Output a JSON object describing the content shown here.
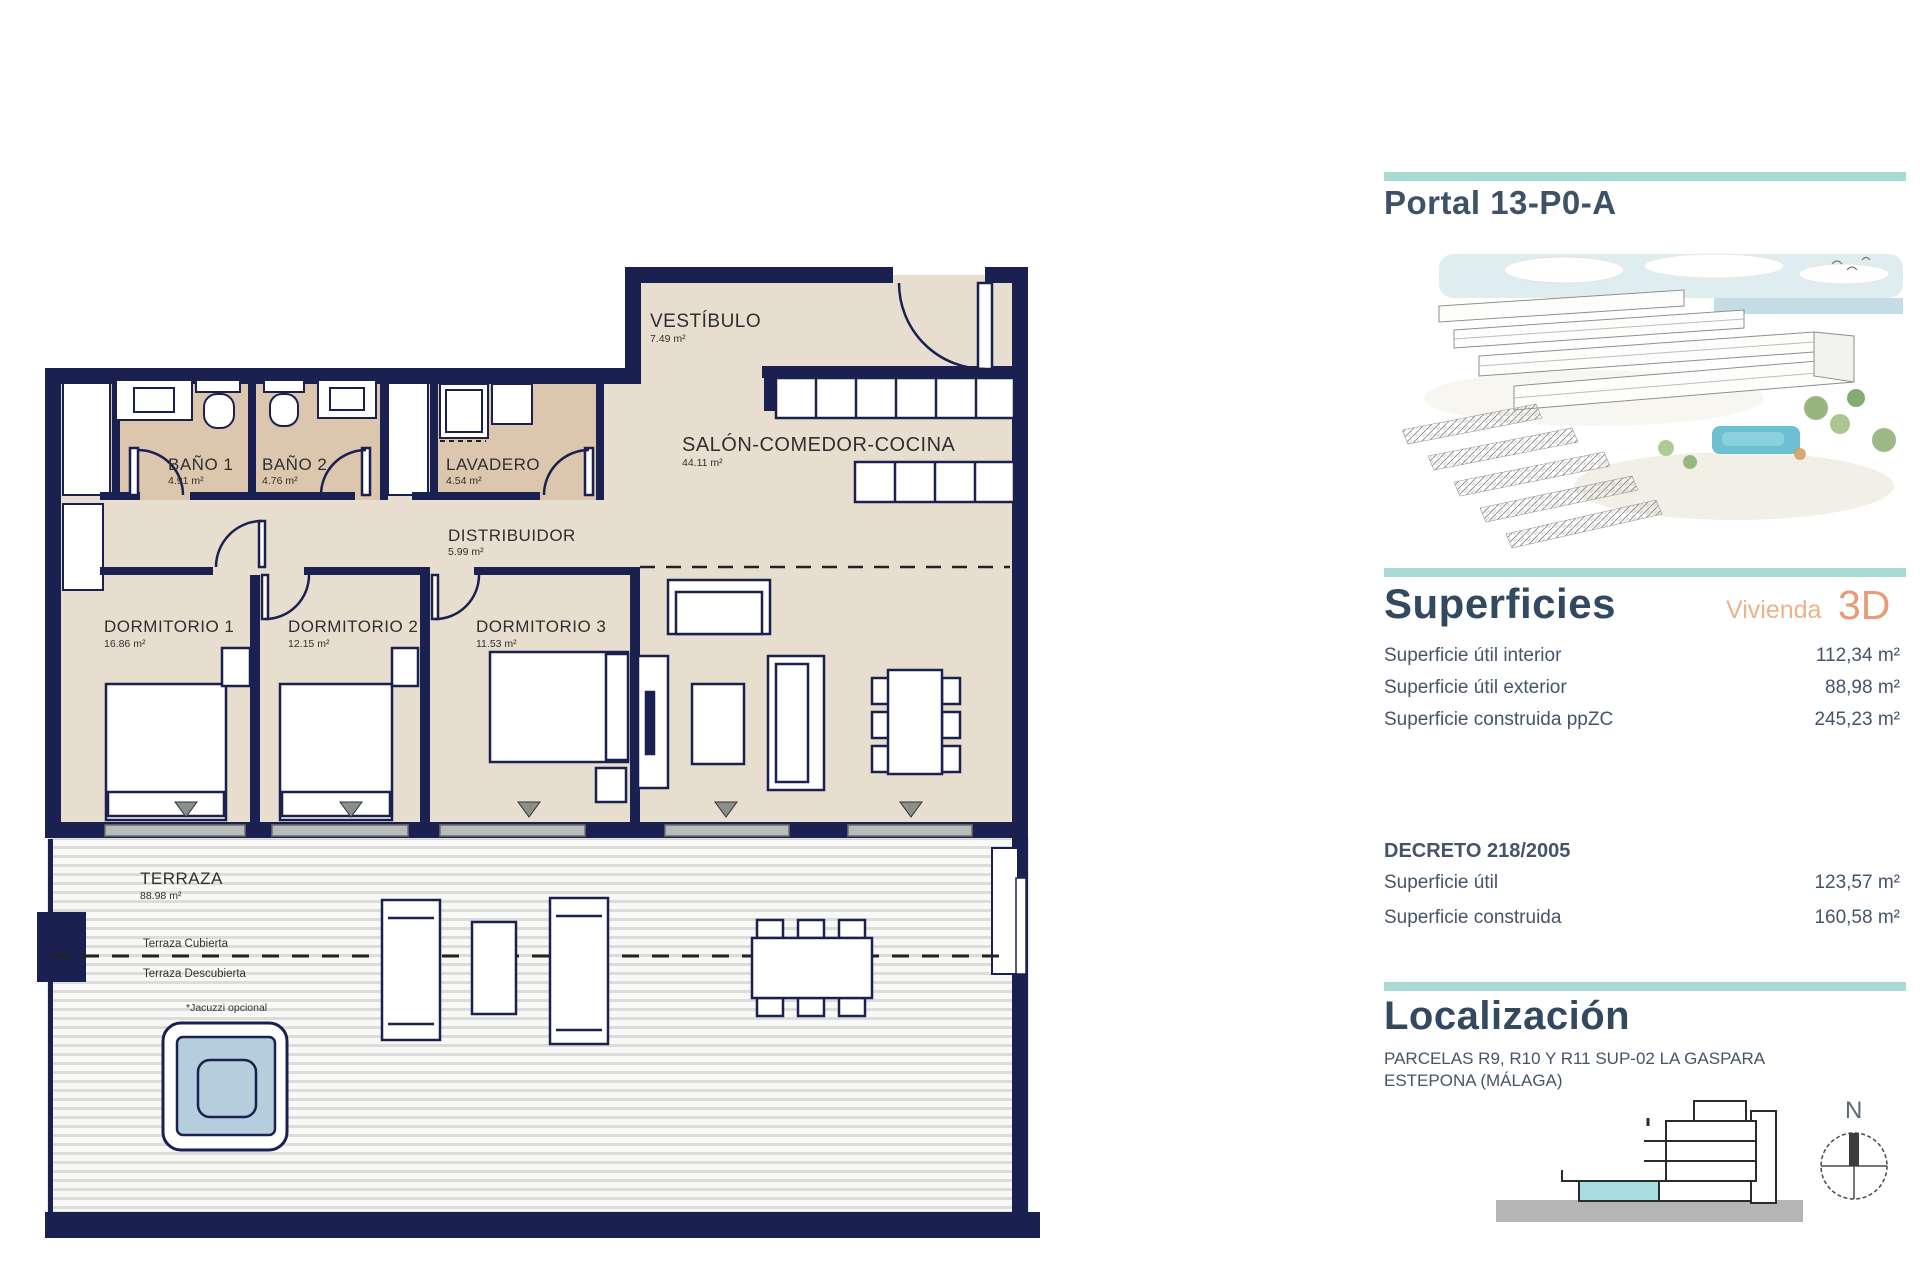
{
  "plan": {
    "rooms": [
      {
        "name": "VESTÍBULO",
        "area": "7.49 m²"
      },
      {
        "name": "SALÓN-COMEDOR-COCINA",
        "area": "44.11 m²"
      },
      {
        "name": "BAÑO 1",
        "area": "4.91 m²"
      },
      {
        "name": "BAÑO 2",
        "area": "4.76 m²"
      },
      {
        "name": "LAVADERO",
        "area": "4.54 m²"
      },
      {
        "name": "DISTRIBUIDOR",
        "area": "5.99 m²"
      },
      {
        "name": "DORMITORIO 1",
        "area": "16.86 m²"
      },
      {
        "name": "DORMITORIO 2",
        "area": "12.15 m²"
      },
      {
        "name": "DORMITORIO 3",
        "area": "11.53 m²"
      },
      {
        "name": "TERRAZA",
        "area": "88.98 m²"
      }
    ],
    "annotations": {
      "covered": "Terraza Cubierta",
      "uncovered": "Terraza Descubierta",
      "jacuzzi": "*Jacuzzi opcional"
    }
  },
  "sidebar": {
    "title": "Portal 13-P0-A",
    "superficies": {
      "heading": "Superficies",
      "unit_label": "Vivienda",
      "unit_type": "3D",
      "rows": [
        {
          "label": "Superficie útil interior",
          "value": "112,34 m²"
        },
        {
          "label": "Superficie útil exterior",
          "value": "88,98 m²"
        },
        {
          "label": "Superficie construida ppZC",
          "value": "245,23 m²"
        }
      ]
    },
    "decreto": {
      "heading": "DECRETO 218/2005",
      "rows": [
        {
          "label": "Superficie útil",
          "value": "123,57 m²"
        },
        {
          "label": "Superficie construida",
          "value": "160,58 m²"
        }
      ]
    },
    "localizacion": {
      "heading": "Localización",
      "address_line1": "PARCELAS R9, R10 Y R11 SUP-02 LA GASPARA",
      "address_line2": "ESTEPONA (MÁLAGA)",
      "compass_north": "N"
    }
  },
  "colors": {
    "wall_navy": "#1a2150",
    "floor_beige": "#e8decf",
    "bath_tan": "#dcc6ae",
    "accent_teal": "#a7dad2",
    "accent_salmon": "#e89b75",
    "heading_navy": "#33495f",
    "jacuzzi_blue": "#b5cedd",
    "unit_cyan": "#a8dde2"
  }
}
